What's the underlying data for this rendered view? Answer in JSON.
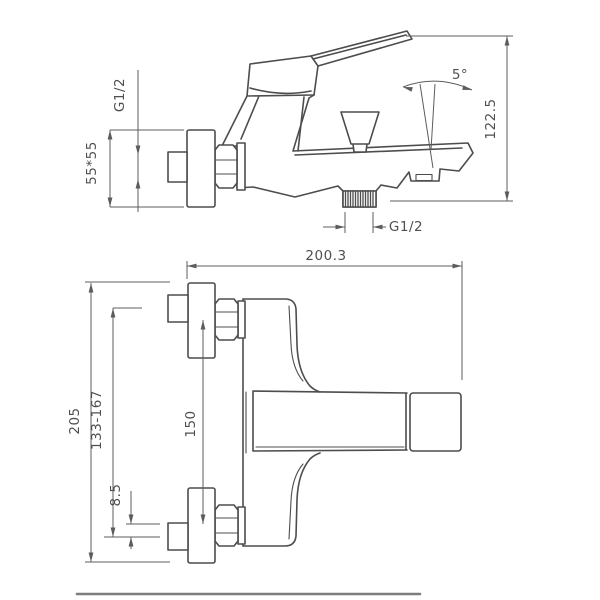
{
  "colors": {
    "line": "#4d4d4d",
    "dim": "#5c5c5c",
    "text": "#4f4f4f"
  },
  "side_view": {
    "labels": {
      "inlet_thread": "G1/2",
      "escutcheon_size": "55*55",
      "overall_height": "122.5",
      "spout_angle": "5°",
      "outlet_thread": "G1/2"
    }
  },
  "plan_view": {
    "labels": {
      "projection_length": "200.3",
      "overall_width": "205",
      "adjustment_range": "133-167",
      "inlet_spacing": "150",
      "eccentric_offset": "8.5"
    }
  }
}
